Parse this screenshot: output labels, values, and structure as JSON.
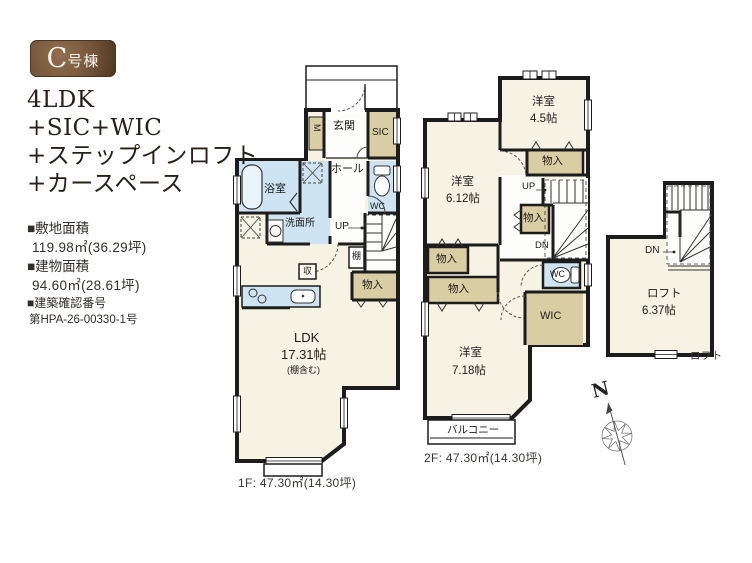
{
  "badge": {
    "prefix": "C",
    "suffix": "号棟"
  },
  "title": {
    "line1": "4LDK",
    "line2": "+SIC+WIC",
    "line3": "+ステップインロフト",
    "line4": "+カースペース"
  },
  "specs": {
    "site_label": "■敷地面積",
    "site_value": "119.98㎡(36.29坪)",
    "building_label": "■建物面積",
    "building_value": "94.60㎡(28.61坪)",
    "permit_label": "■建築確認番号",
    "permit_value": "第HPA-26-00330-1号"
  },
  "floor1": {
    "entrance": "玄関",
    "sic": "SIC",
    "meter": "M",
    "hall": "ホール",
    "bath": "浴室",
    "washroom": "洗面所",
    "wc": "WC",
    "up": "UP",
    "shelf": "棚",
    "storage": "収",
    "closet": "物入",
    "ldk_name": "LDK",
    "ldk_size": "17.31帖",
    "ldk_note": "(棚含む)",
    "caption": "1F: 47.30㎡(14.30坪)"
  },
  "floor2": {
    "room1_name": "洋室",
    "room1_size": "4.5帖",
    "room2_name": "洋室",
    "room2_size": "6.12帖",
    "room3_name": "洋室",
    "room3_size": "7.18帖",
    "closet1": "物入",
    "closet2": "物入",
    "closet3": "物入",
    "closet4": "物入",
    "up": "UP",
    "dn": "DN",
    "wc": "WC",
    "wic": "WIC",
    "balcony": "バルコニー",
    "caption": "2F: 47.30㎡(14.30坪)"
  },
  "loft": {
    "dn": "DN",
    "name": "ロフト",
    "size": "6.37帖",
    "caption": "ロフト"
  },
  "compass": {
    "north": "N"
  },
  "colors": {
    "badge_brown": "#7a5a3e",
    "closet_beige": "#d9cda4",
    "wet_area_blue": "#cfe4f2",
    "floor_cream": "#f6f3e5",
    "wall_black": "#1c1c1c"
  }
}
